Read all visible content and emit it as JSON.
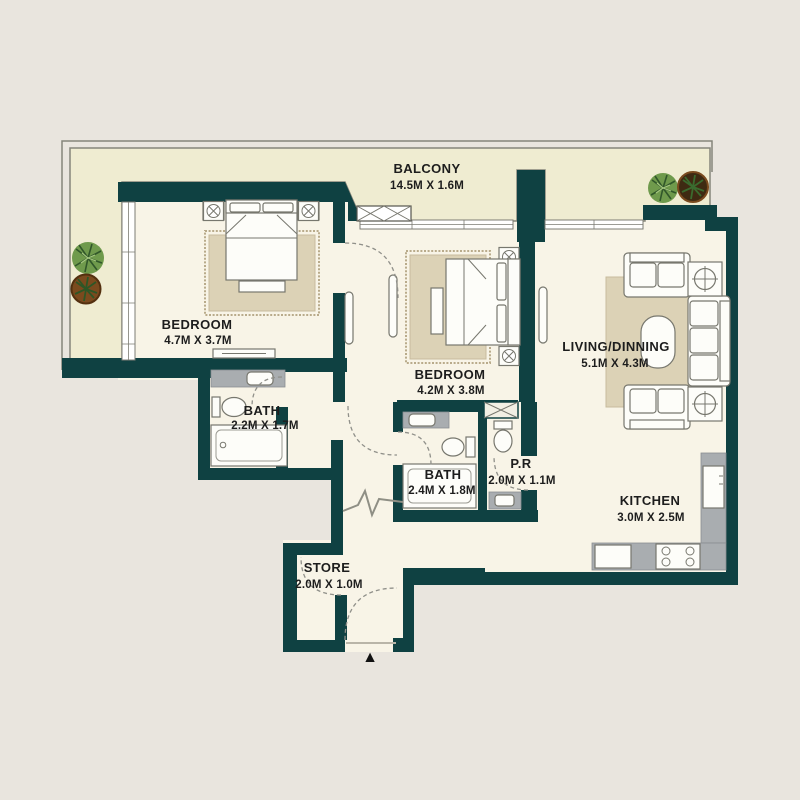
{
  "plan": {
    "colors": {
      "wall": "#0f4142",
      "room_floor": "#f8f4e7",
      "balcony_floor": "#efecd1",
      "outside_background": "#e9e5de",
      "counter_gray": "#a9adb0",
      "rug_tan": "#dcd2b6",
      "label_text": "#1d1d1d"
    },
    "entrance_marker": "▲",
    "rooms": [
      {
        "id": "balcony",
        "name": "BALCONY",
        "dims": "14.5M X 1.6M"
      },
      {
        "id": "bedroom-1",
        "name": "BEDROOM",
        "dims": "4.7M X 3.7M"
      },
      {
        "id": "bath-1",
        "name": "BATH",
        "dims": "2.2M X 1.7M"
      },
      {
        "id": "bedroom-2",
        "name": "BEDROOM",
        "dims": "4.2M X 3.8M"
      },
      {
        "id": "bath-2",
        "name": "BATH",
        "dims": "2.4M X 1.8M"
      },
      {
        "id": "powder-room",
        "name": "P.R",
        "dims": "2.0M X 1.1M"
      },
      {
        "id": "living-dining",
        "name": "LIVING/DINNING",
        "dims": "5.1M X 4.3M"
      },
      {
        "id": "kitchen",
        "name": "KITCHEN",
        "dims": "3.0M X 2.5M"
      },
      {
        "id": "store",
        "name": "STORE",
        "dims": "2.0M X 1.0M"
      }
    ]
  }
}
